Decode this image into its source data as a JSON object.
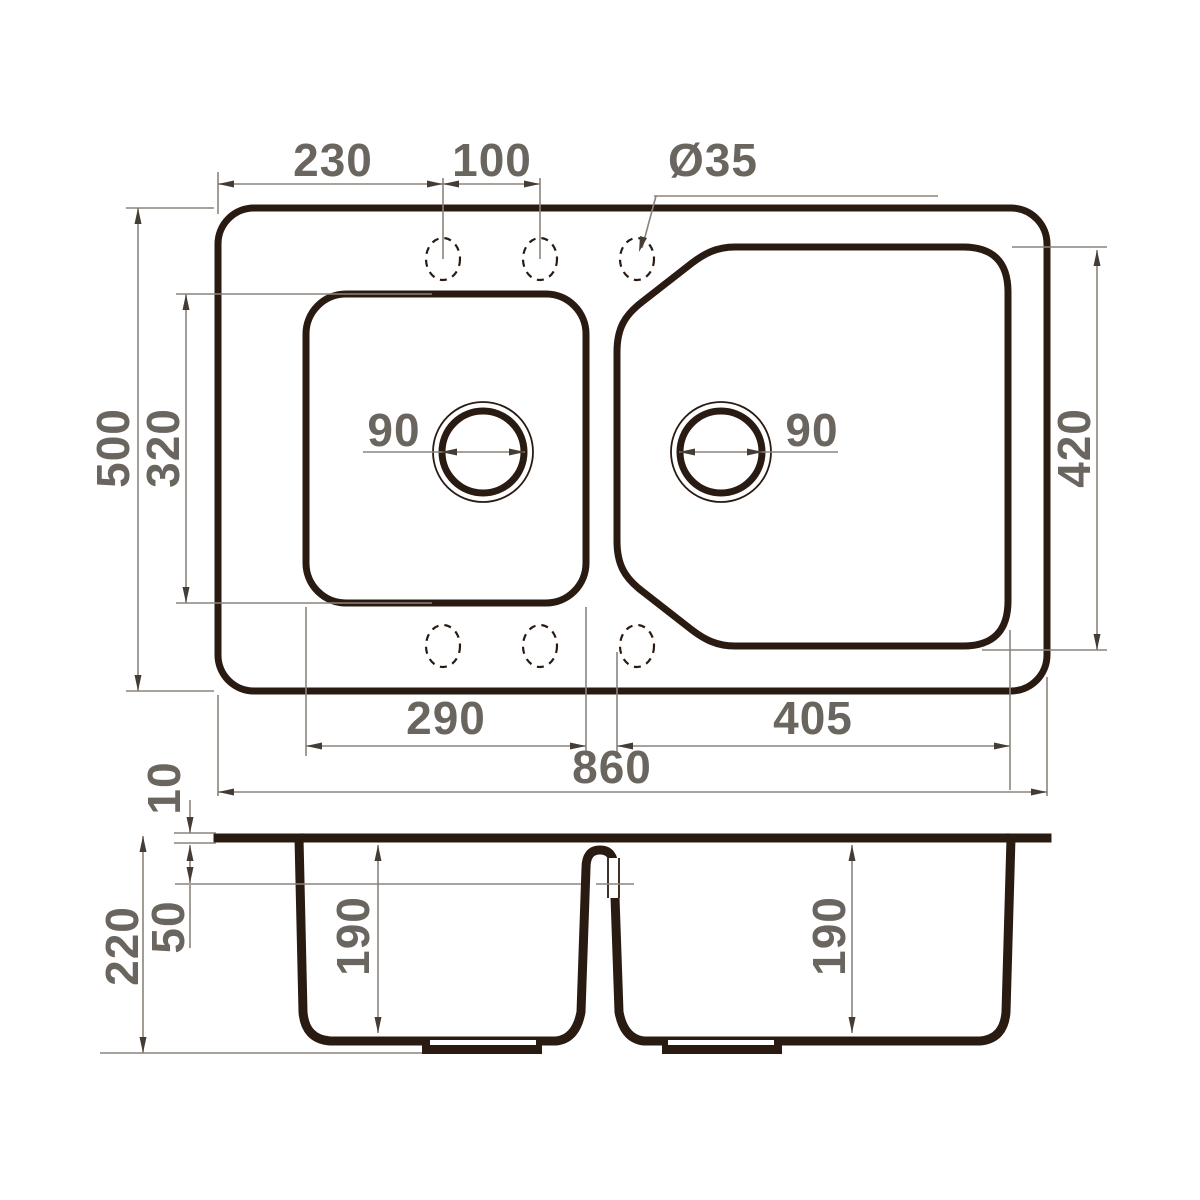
{
  "drawing": {
    "type": "sink-technical-drawing",
    "views": {
      "plan": "top view",
      "section": "cross-section"
    }
  },
  "colors": {
    "background": "#ffffff",
    "ink": "#2a1b12",
    "dim_line": "#8b837b",
    "arrow": "#453c34",
    "dim_text": "#6b655f"
  },
  "top_view": {
    "tap_hole_offset": "230",
    "tap_hole_spacing": "100",
    "tap_hole_diameter": "Ø35",
    "overall_height": "500",
    "left_bowl_height": "320",
    "right_bowl_height": "420",
    "left_drain_diameter": "90",
    "right_drain_diameter": "90",
    "left_bowl_width": "290",
    "right_bowl_width": "405",
    "overall_width": "860"
  },
  "section_view": {
    "rim_height": "10",
    "rim_to_overflow_level": "50",
    "overall_depth": "220",
    "left_bowl_depth": "190",
    "right_bowl_depth": "190"
  }
}
